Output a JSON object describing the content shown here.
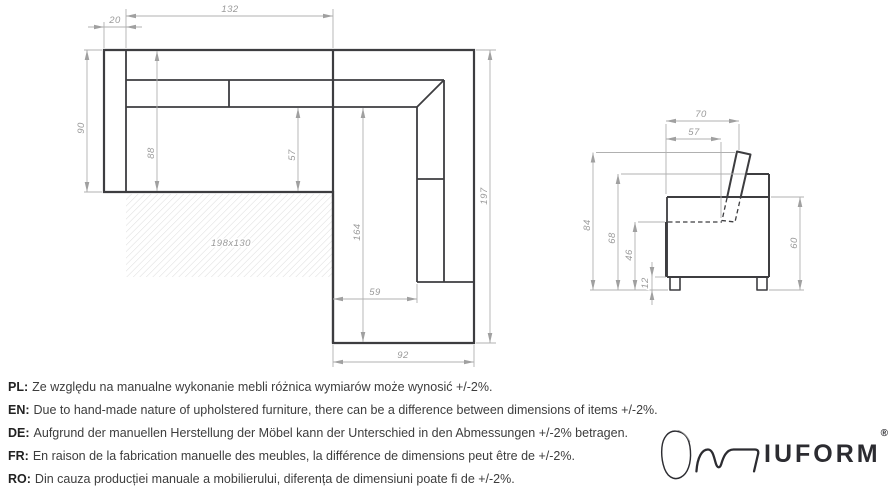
{
  "drawing": {
    "top_view": {
      "dims": {
        "armrest_width": "20",
        "seat_width": "132",
        "depth": "90",
        "inner_depth": "88",
        "seat_depth": "57",
        "chaise_inner_length": "164",
        "total_length": "197",
        "chaise_seat_width": "59",
        "chaise_width": "92",
        "sleeping_area": "198x130"
      }
    },
    "side_view": {
      "dims": {
        "total_depth": "70",
        "seat_front_depth": "57",
        "total_height": "84",
        "back_height": "68",
        "seat_height": "46",
        "leg_height": "12",
        "body_height": "60"
      }
    }
  },
  "notes": [
    {
      "prefix": "PL:",
      "text": "Ze względu na manualne wykonanie mebli różnica wymiarów może wynosić +/-2%."
    },
    {
      "prefix": "EN:",
      "text": "Due to hand-made nature of upholstered furniture, there can be a difference between dimensions of items +/-2%."
    },
    {
      "prefix": "DE:",
      "text": "Aufgrund der manuellen Herstellung der Möbel kann der Unterschied in den Abmessungen +/-2% betragen."
    },
    {
      "prefix": "FR:",
      "text": "En raison de la fabrication manuelle des meubles, la différence de dimensions peut être de +/-2%."
    },
    {
      "prefix": "RO:",
      "text": "Din cauza producției manuale a mobilierului, diferența de dimensiuni poate fi de +/-2%."
    }
  ],
  "logo": {
    "wordmark": "IUFORM",
    "registered": "®"
  },
  "colors": {
    "outline": "#3d3d40",
    "dimension": "#a8a8a8",
    "dimension_text": "#9a9a9a",
    "hatch": "#dcdcdc"
  }
}
